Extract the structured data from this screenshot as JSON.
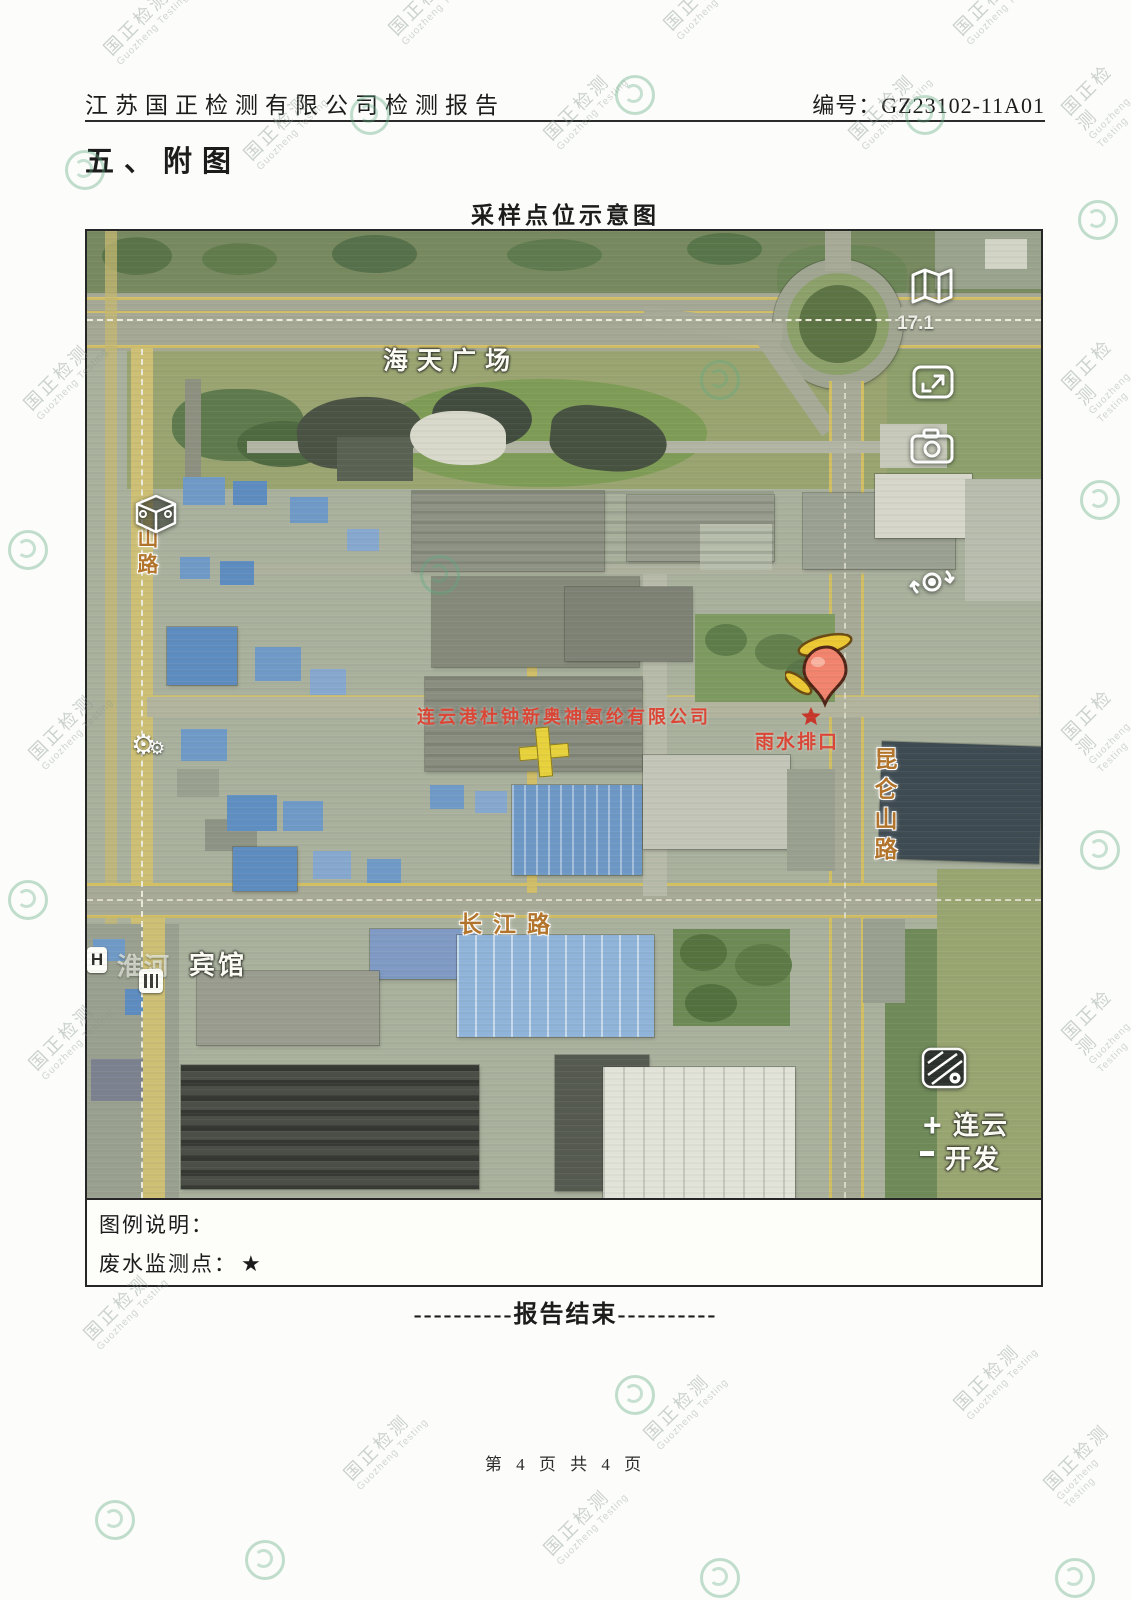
{
  "watermark": {
    "cn": "国正检测",
    "en": "Guozheng Testing"
  },
  "header": {
    "report_title": "江苏国正检测有限公司检测报告",
    "report_no": "编号：GZ23102-11A01"
  },
  "section": {
    "title": "五、附图"
  },
  "figure": {
    "title": "采样点位示意图",
    "map_labels": {
      "plaza": "海天广场",
      "left_road": "山路",
      "right_road": "昆仑山路",
      "bottom_road": "长江路",
      "hotel_faint": "淮河",
      "hotel": "宾馆",
      "company": "连云港杜钟新奥神氨纶有限公司",
      "outlet": "雨水排口",
      "outlet_star": "★",
      "zoom_level": "17.1",
      "district_line1": "连云",
      "district_line2": "开发",
      "zoom_in": "+"
    },
    "icons": {
      "folded_map": "map-panels",
      "fullscreen": "expand-frame",
      "camera": "camera",
      "street_view": "camera-rotate",
      "cube_poi": "3d-cube",
      "factory_poi": "⚙",
      "hotel_poi": "H",
      "building_poi": "striped-building",
      "satellite_layer": "map-pin-grid",
      "marker": "location-pin"
    }
  },
  "legend": {
    "heading": "图例说明：",
    "item_label": "废水监测点：",
    "item_symbol": "★"
  },
  "end_marker": "----------报告结束----------",
  "footer": {
    "page": "第 4 页 共 4 页"
  }
}
